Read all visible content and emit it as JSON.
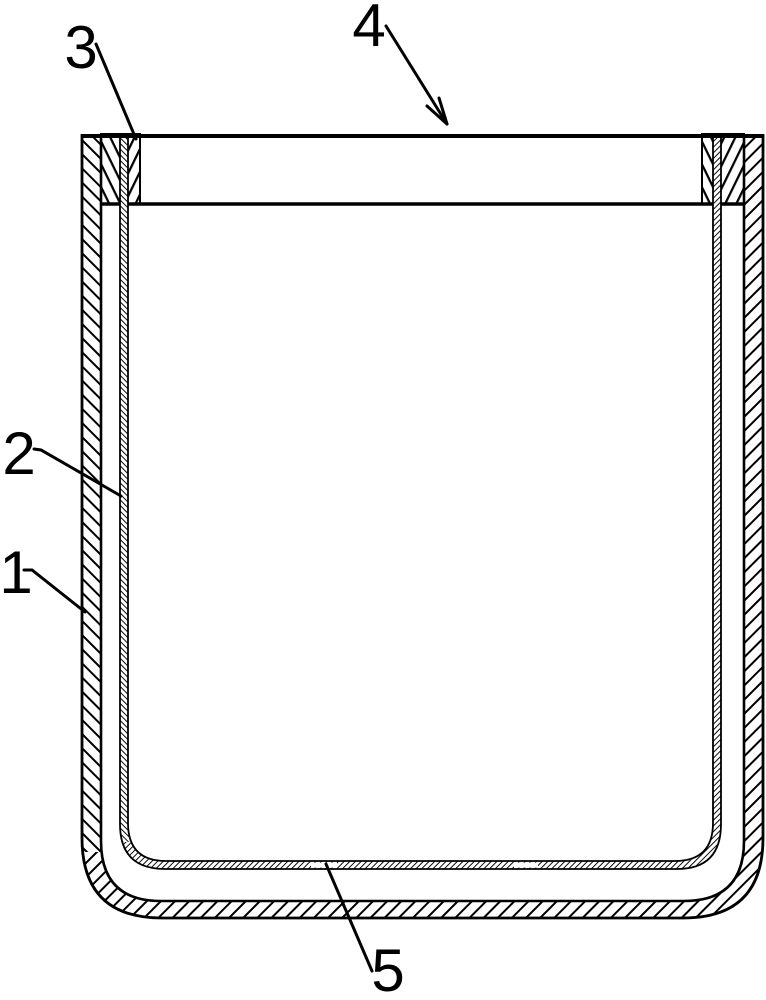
{
  "figure": {
    "background_color": "#ffffff",
    "ink_color": "#000000",
    "reference_labels": [
      {
        "id": "label-1",
        "text": "1",
        "points_to": "outer-wall"
      },
      {
        "id": "label-2",
        "text": "2",
        "points_to": "inner-liner"
      },
      {
        "id": "label-3",
        "text": "3",
        "points_to": "collar-left"
      },
      {
        "id": "label-4",
        "text": "4",
        "points_to": "top-rim"
      },
      {
        "id": "label-5",
        "text": "5",
        "points_to": "liner-bottom-slot"
      }
    ]
  }
}
